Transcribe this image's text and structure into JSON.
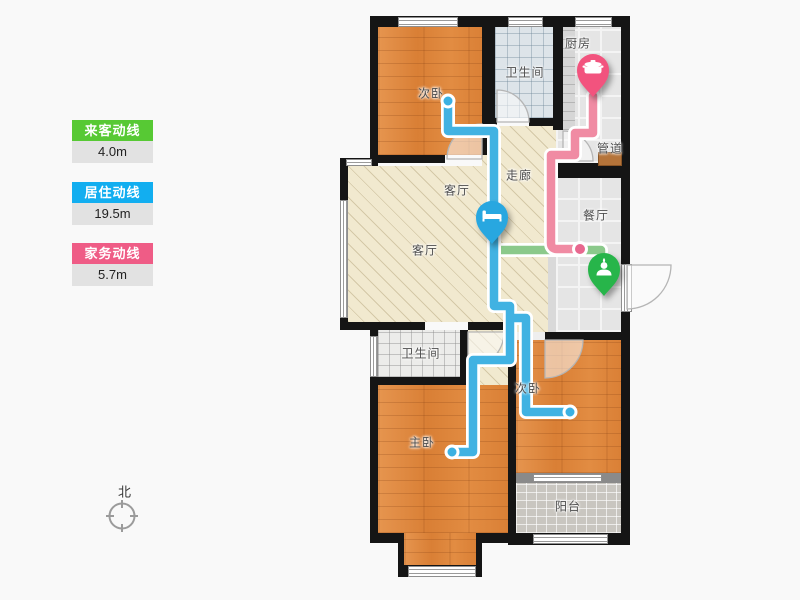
{
  "legend": {
    "items": [
      {
        "key": "visitor",
        "label": "来客动线",
        "value": "4.0m",
        "color": "#57c934"
      },
      {
        "key": "resident",
        "label": "居住动线",
        "value": "19.5m",
        "color": "#12aef0"
      },
      {
        "key": "housework",
        "label": "家务动线",
        "value": "5.7m",
        "color": "#ef5c86"
      }
    ]
  },
  "rooms": {
    "bedroom_top": "次卧",
    "bathroom_top": "卫生间",
    "kitchen": "厨房",
    "duct": "管道",
    "hallway": "走廊",
    "living_upper": "客厅",
    "living": "客厅",
    "dining": "餐厅",
    "bathroom_mid": "卫生间",
    "bedroom_right": "次卧",
    "master_bedroom": "主卧",
    "balcony": "阳台"
  },
  "compass": {
    "north_label": "北"
  },
  "pins": [
    {
      "name": "kitchen-pin",
      "icon": "pot-icon",
      "color": "#f2537e"
    },
    {
      "name": "bed-pin",
      "icon": "bed-icon",
      "color": "#28a7e0"
    },
    {
      "name": "entrance-pin",
      "icon": "person-icon",
      "color": "#27b54a"
    }
  ],
  "route_colors": {
    "visitor": "#8bc98b",
    "resident": "#41b2e2",
    "housework": "#f08ba3"
  }
}
